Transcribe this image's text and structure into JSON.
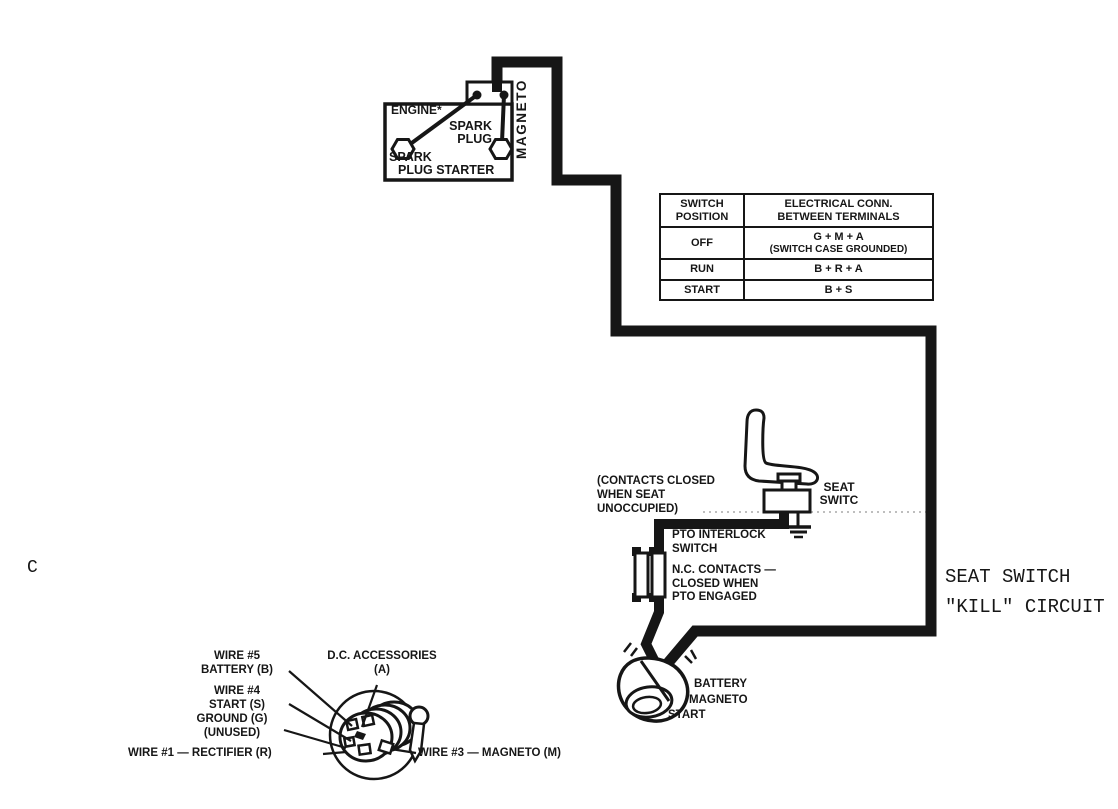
{
  "page": {
    "background": "#ffffff",
    "ink": "#161616",
    "marker": "C"
  },
  "engine": {
    "title": "ENGINE*",
    "magneto": "MAGNETO",
    "spark_plug": [
      "SPARK",
      "PLUG"
    ],
    "spark_plug_starter": [
      "SPARK",
      "PLUG STARTER"
    ]
  },
  "switch_table": {
    "col_position": [
      "SWITCH",
      "POSITION"
    ],
    "col_connection": [
      "ELECTRICAL CONN.",
      "BETWEEN TERMINALS"
    ],
    "rows": [
      {
        "position": "OFF",
        "connection": "G + M + A",
        "note": "(SWITCH CASE GROUNDED)"
      },
      {
        "position": "RUN",
        "connection": "B + R + A",
        "note": ""
      },
      {
        "position": "START",
        "connection": "B + S",
        "note": ""
      }
    ]
  },
  "seat_area": {
    "contacts_note": [
      "(CONTACTS CLOSED",
      "WHEN SEAT",
      "UNOCCUPIED)"
    ],
    "seat_switch": [
      "SEAT",
      "SWITC"
    ],
    "pto_interlock": [
      "PTO INTERLOCK",
      "SWITCH"
    ],
    "nc_contacts": [
      "N.C. CONTACTS —",
      "CLOSED WHEN",
      "PTO ENGAGED"
    ]
  },
  "kill_circuit": [
    "SEAT SWITCH",
    "\"KILL\" CIRCUIT"
  ],
  "ignition_switch": [
    "BATTERY",
    "MAGNETO",
    "START"
  ],
  "key_switch": {
    "wire5": [
      "WIRE #5",
      "BATTERY (B)"
    ],
    "dc_accessories": [
      "D.C. ACCESSORIES",
      "(A)"
    ],
    "wire4": [
      "WIRE #4",
      "START (S)"
    ],
    "ground": [
      "GROUND (G)",
      "(UNUSED)"
    ],
    "wire1": "WIRE #1 — RECTIFIER (R)",
    "wire3": "WIRE #3 — MAGNETO (M)"
  }
}
